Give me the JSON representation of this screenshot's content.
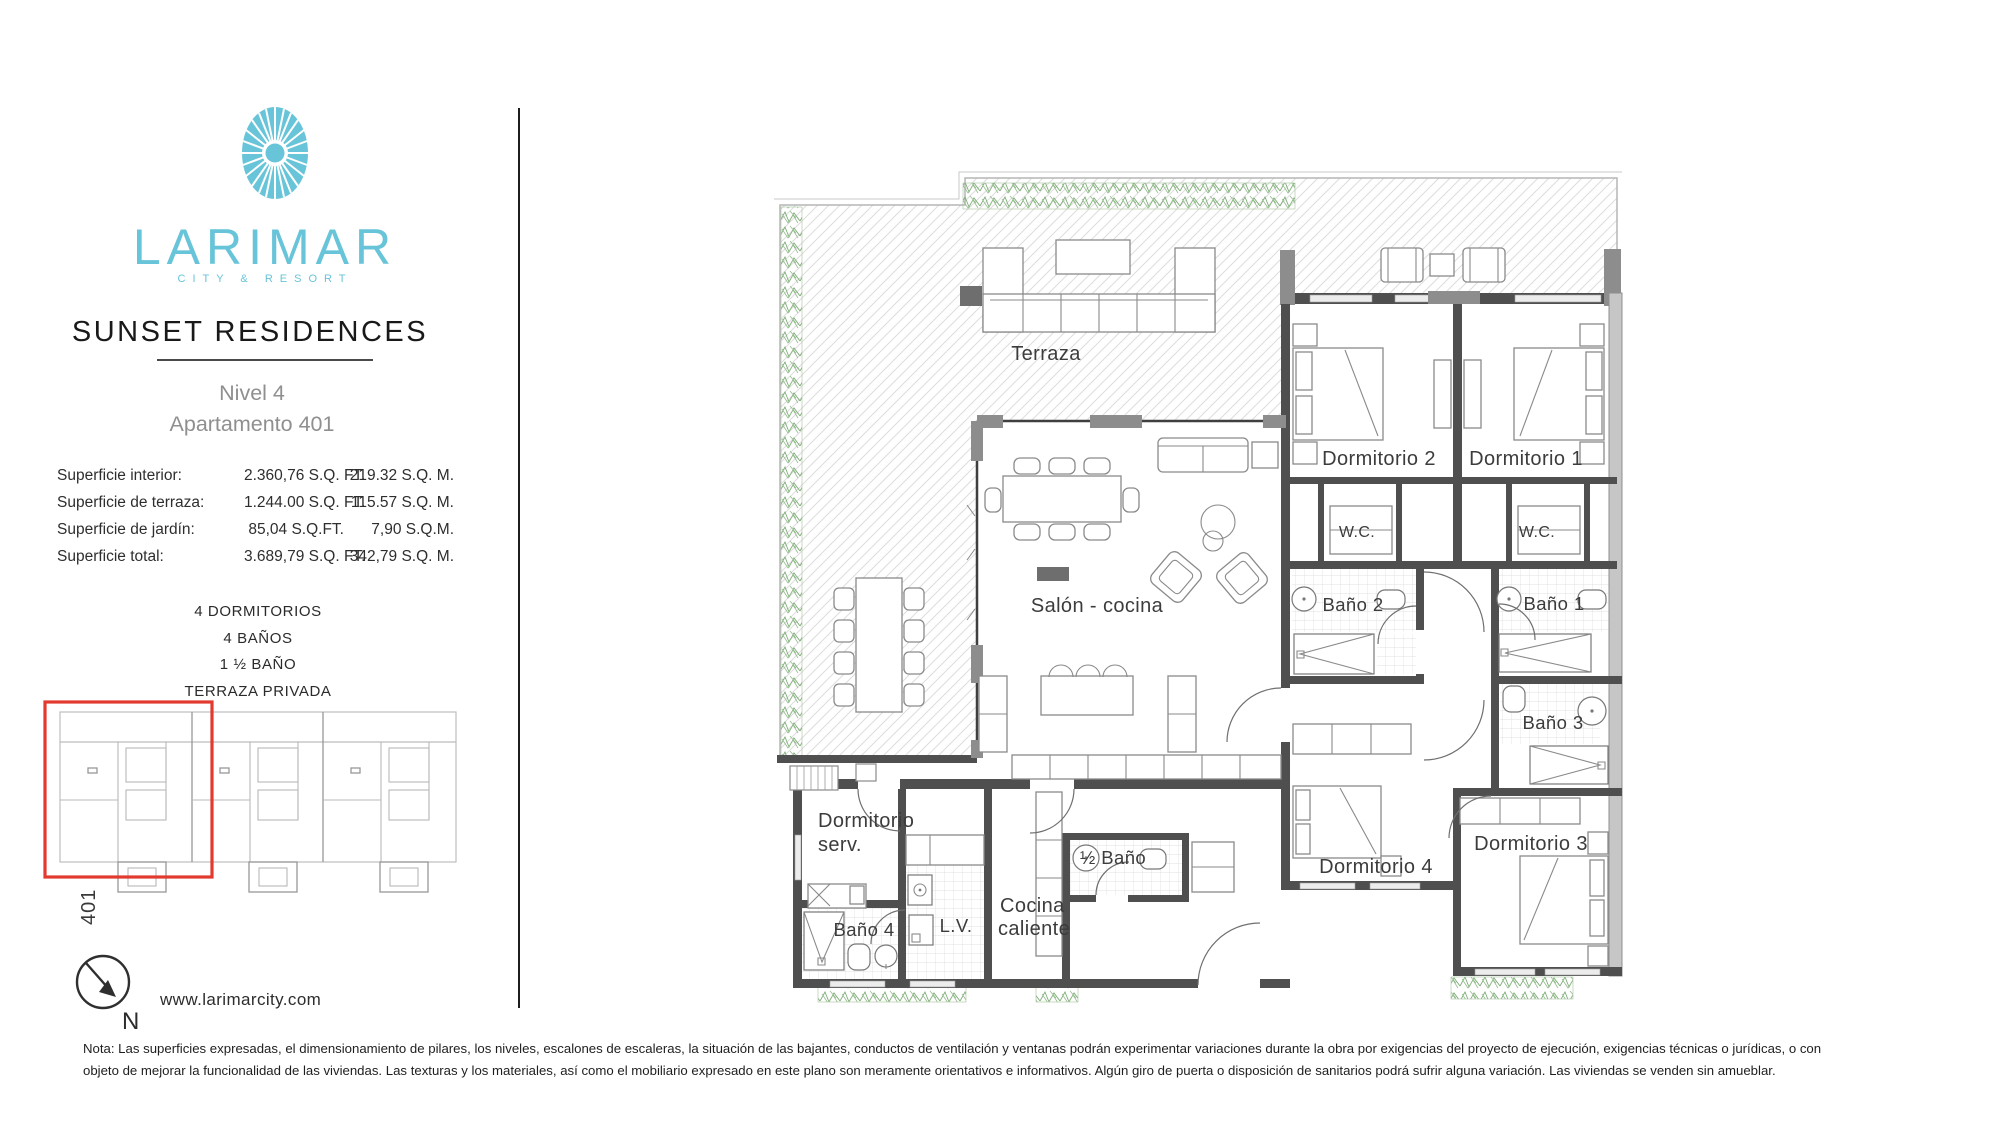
{
  "brand": {
    "name": "LARIMAR",
    "tagline": "CITY & RESORT",
    "accent_color": "#68c4d8"
  },
  "header": {
    "title": "SUNSET RESIDENCES",
    "level": "Nivel 4",
    "apartment": "Apartamento 401"
  },
  "areas": {
    "rows": [
      {
        "label": "Superficie interior:",
        "sqft": "2.360,76 S.Q. FT.",
        "sqm": "219.32 S.Q. M."
      },
      {
        "label": "Superficie de terraza:",
        "sqft": "1.244.00 S.Q. FT.",
        "sqm": "115.57 S.Q. M."
      },
      {
        "label": "Superficie de jardín:",
        "sqft": "85,04 S.Q.FT.",
        "sqm": "7,90 S.Q.M."
      },
      {
        "label": "Superficie total:",
        "sqft": "3.689,79 S.Q. FT.",
        "sqm": "342,79 S.Q. M."
      }
    ]
  },
  "features": [
    "4 DORMITORIOS",
    "4 BAÑOS",
    "1 ½ BAÑO",
    "TERRAZA PRIVADA"
  ],
  "site_plan": {
    "unit_label": "401",
    "highlight_color": "#e23a2e"
  },
  "compass": {
    "label": "N"
  },
  "website": "www.larimarcity.com",
  "note": {
    "line1": "Nota: Las superficies expresadas, el dimensionamiento de pilares, los niveles, escalones de escaleras, la situación de las bajantes, conductos de ventilación y ventanas podrán experimentar variaciones durante la obra por exigencias del proyecto de ejecución, exigencias técnicas o jurídicas, o con",
    "line2": "objeto de mejorar la funcionalidad de las viviendas. Las texturas y los materiales, así como el mobiliario expresado en este plano son meramente orientativos e informativos. Algún giro de puerta o disposición de sanitarios podrá sufrir alguna variación. Las viviendas se venden sin amueblar."
  },
  "plan": {
    "labels": {
      "terraza": "Terraza",
      "salon": "Salón - cocina",
      "dorm1": "Dormitorio 1",
      "dorm2": "Dormitorio 2",
      "dorm3": "Dormitorio 3",
      "dorm4": "Dormitorio 4",
      "dorm_serv_1": "Dormitorio",
      "dorm_serv_2": "serv.",
      "wc1": "W.C.",
      "wc2": "W.C.",
      "bano1": "Baño 1",
      "bano2": "Baño 2",
      "bano3": "Baño 3",
      "bano4": "Baño 4",
      "half_bano": "½ Baño",
      "cocina_1": "Cocina",
      "cocina_2": "caliente",
      "lv": "L.V."
    }
  }
}
